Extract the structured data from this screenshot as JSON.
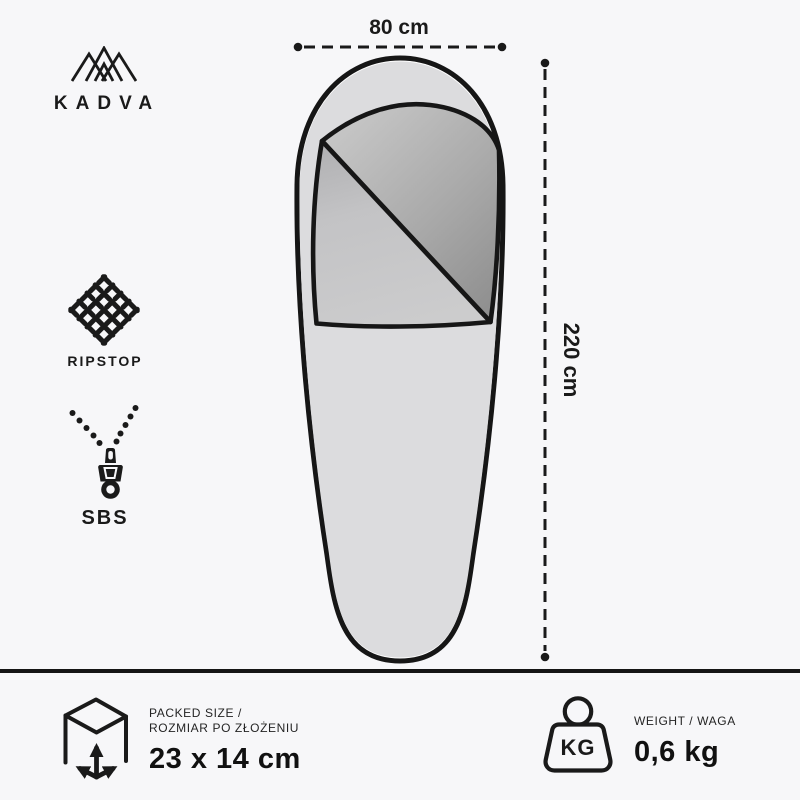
{
  "brand": {
    "name": "KADVA"
  },
  "icons": {
    "logo": "mountain-peaks",
    "ripstop": "fabric-weave",
    "sbs": "zipper-pull",
    "width_line": "dashed-dimension-horizontal",
    "length_line": "dashed-dimension-vertical",
    "packed": "cube-with-dimension-arrows",
    "weight": "kettlebell-kg"
  },
  "features": [
    {
      "label": "RIPSTOP"
    },
    {
      "label": "SBS"
    }
  ],
  "dimensions": {
    "width_label": "80 cm",
    "length_label": "220 cm"
  },
  "footer": {
    "packed": {
      "title_line1": "PACKED SIZE /",
      "title_line2": "ROZMIAR PO ZŁOŻENIU",
      "value": "23 x 14 cm"
    },
    "weight": {
      "icon_label": "KG",
      "title": "WEIGHT / WAGA",
      "value": "0,6 kg"
    }
  },
  "colors": {
    "background": "#f7f7f9",
    "ink": "#1a1a1a",
    "bag_fill": "#dcdcde",
    "bag_rim": "#ffffff",
    "hood_gradient_light": "#c8c8c8",
    "hood_gradient_dark": "#8d8d8d",
    "flap_gradient_dark": "#b2b2b4",
    "flap_gradient_light": "#cccccd"
  }
}
